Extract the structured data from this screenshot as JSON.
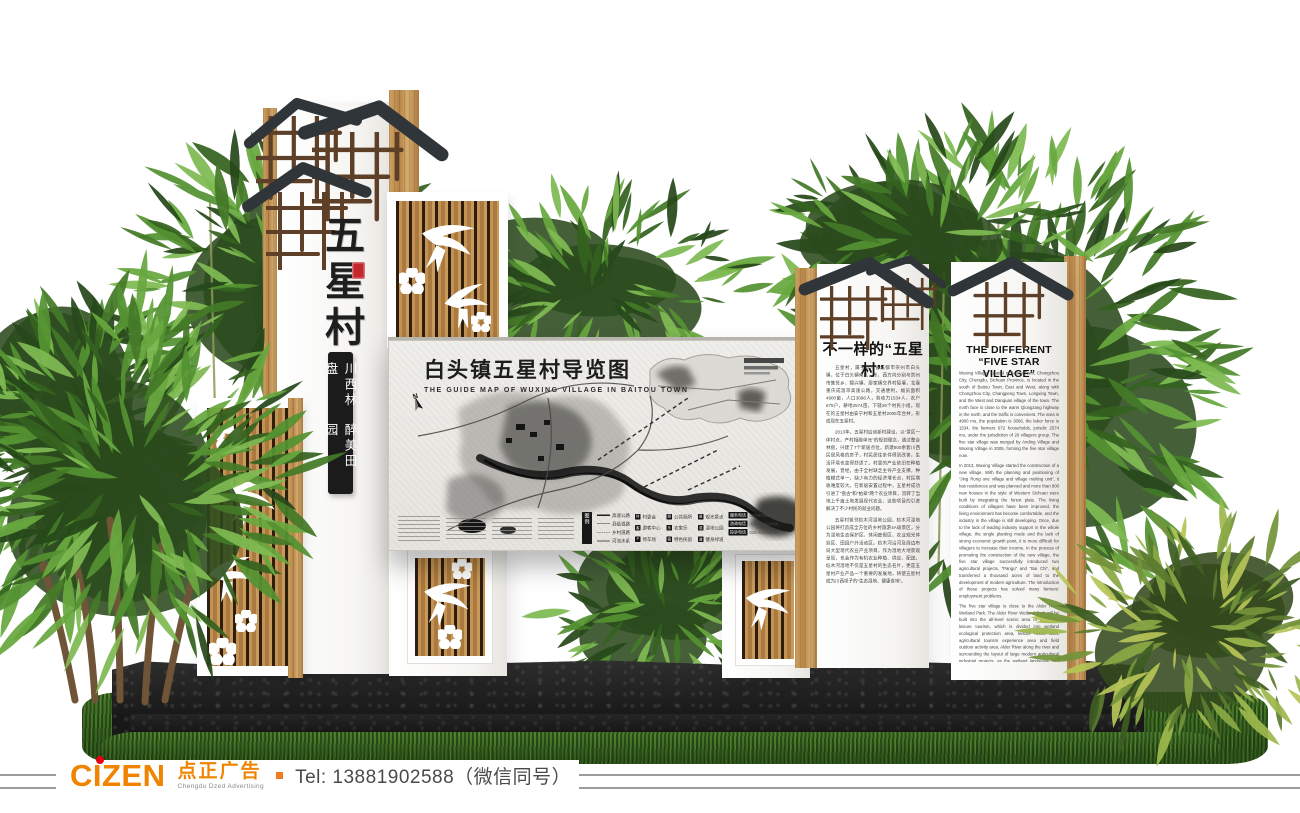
{
  "scene": {
    "type": "3d-render-signage-mockup",
    "background_color": "#ffffff",
    "accent_wood": "#c09050",
    "roof_color": "#30353a"
  },
  "left_totem": {
    "title_vertical": "五星村",
    "banner_lines": [
      "川西林盘",
      "醉美田园"
    ],
    "seal_color": "#c3272b"
  },
  "map_board": {
    "title": "白头镇五星村导览图",
    "subtitle": "THE GUIDE MAP OF WUXING VILLAGE IN BAITOU TOWN",
    "compass_label": "N",
    "legend_header": "图例",
    "road_samples": [
      {
        "label": "高速公路"
      },
      {
        "label": "县级道路"
      },
      {
        "label": "乡村道路"
      },
      {
        "label": "河流水系"
      }
    ],
    "legend_items": [
      {
        "icon": "村",
        "label": "村委会"
      },
      {
        "icon": "客",
        "label": "游客中心"
      },
      {
        "icon": "P",
        "label": "停车场"
      },
      {
        "icon": "厕",
        "label": "公共厕所"
      },
      {
        "icon": "乐",
        "label": "农家乐"
      },
      {
        "icon": "宿",
        "label": "特色民宿"
      },
      {
        "icon": "景",
        "label": "观光景点"
      },
      {
        "icon": "湿",
        "label": "湿地公园"
      },
      {
        "icon": "道",
        "label": "健身绿道"
      }
    ],
    "service_calls": [
      {
        "label": "服务电话",
        "number": "028-XXXXXXX"
      },
      {
        "label": "咨询电话",
        "number": "028-XXXXXXX"
      },
      {
        "label": "投诉电话",
        "number": "028-XXXXXXX"
      }
    ]
  },
  "cn_panel": {
    "title": "不一样的“五星村”",
    "paragraphs": [
      "五星村，属于四川省成都市崇州市白头镇，位于白头镇南区，东、西方向分别与崇州市集贤乡、锦兴镇、廖家镇交界村接壤，北靠重庆成温邛高速公路，交通便利，幅员面积4900亩，人口3096人，劳动力1534人，农户675户，耕地2574亩，下辖26个村民小组。现在的五星村由安宁村和五星村2005年合并，形成现在五星村。",
      "2013年，五星村启动新村建设，以“景区一体村点，产村相融单元”的规划理念，通过整合林盘，兴建了7个新居点位，新建800余套川西民居风格的房子，村民居住条件得到改善，生活环境也变得舒适了。村里的产业依旧在种植发展，曾经，由于全村缺乏主导产业支撑，种植模式单一，缺少有力的经济增长点，村民增收难度较大。在新居安置过程中，五星村成功引进了“盘古”和“柏翠”两个农业项目，流转了当地上千亩土地发展现代农业，这些项目的引进解决了不少村民的就业问题。",
      "五星村紧邻桤木河湿地公园，桤木河湿地公园将打造成全方位的乡村旅游4A级景区，分为湿地生态保护区、休闲度假区、农业观光体验区、田园户外活动区。桤木河沿河及周边布局大型现代农业产业项目，作为湿地大地景观呈现，也会作为有机农业种植、供应、配送。桤木河湿地不仅是五星村的生态名片，更是五星村产业产品一个重要的发展地，将使五星村成为川西坝子的“生态湿地、健康食地”。"
    ]
  },
  "en_panel": {
    "title": "THE DIFFERENT “FIVE STAR VILLAGE”",
    "paragraphs": [
      "Wuxing Village, located in Baitou Town, Chongzhou City, Chengdu, Sichuan Province, is located in the south of Baitou Town, East and West, along with Chongzhou City, Changpeng Town, Longxing Town, and the West and Danquan village of the town. The north face is close to the warm Qiongzang highway in the north, and the traffic is convenient. The area is 4900 mu, the population is 3066, the labor force is 1534, the farmers 672 households, jurisdic 2574 mu, under the jurisdiction of 26 villagers group. The five star village was merged by Anding Village and Wuxing Village in 2005, forming the five star village now.",
      "In 2013, Wuxing Village started the construction of a new village. With the planning and positioning of “Jing Rong one village and village melting unit”, it has residences and was planned and more than 800 new houses in the style of Western Sichuan were built by integrating the forest plate. The living conditions of villagers have been improved, the living environment has become comfortable, and the industry in the village is still developing. Once, due to the lack of leading industry support in the whole village, the single planting mode and the lack of strong economic growth point, it is more difficult for villagers to increase their income. In the process of promoting the construction of the new village, the five star village successfully introduced two agricultural projects, “Pangu” and “Bai Chi”, and transferred a thousand acres of land to the development of modern agriculture. The introduction of these projects has solved many farmers’ employment problems.",
      "The five star village is close to the Alder River Wetland Park. The Alder River Wetland Park will be built into the all-level scenic area of ecological leisure tourism, which is divided into wetland ecological protection area, leisure resort area, agricultural tourism experience area and field outdoor activity area. Alder River along the river and surrounding the layout of large modern agricultural industrial projects, as the wetland landscape, but also as the organic food planting, supply, distribution. Alder River wetland is not only the ecological card of Wuxing village, but also an important place for the development of Wuxing village in the future. The Wuxing village has become the “ecological wetland and healthy food land” in the Western Sichuan plain."
    ]
  },
  "brand_bar": {
    "logo_text": "CIZEN",
    "logo_cn": "点正广告",
    "logo_sub": "Chengdu Dzed Advertising",
    "tel": "Tel: 13881902588（微信同号）",
    "orange": "#f08300",
    "red": "#e60012"
  }
}
